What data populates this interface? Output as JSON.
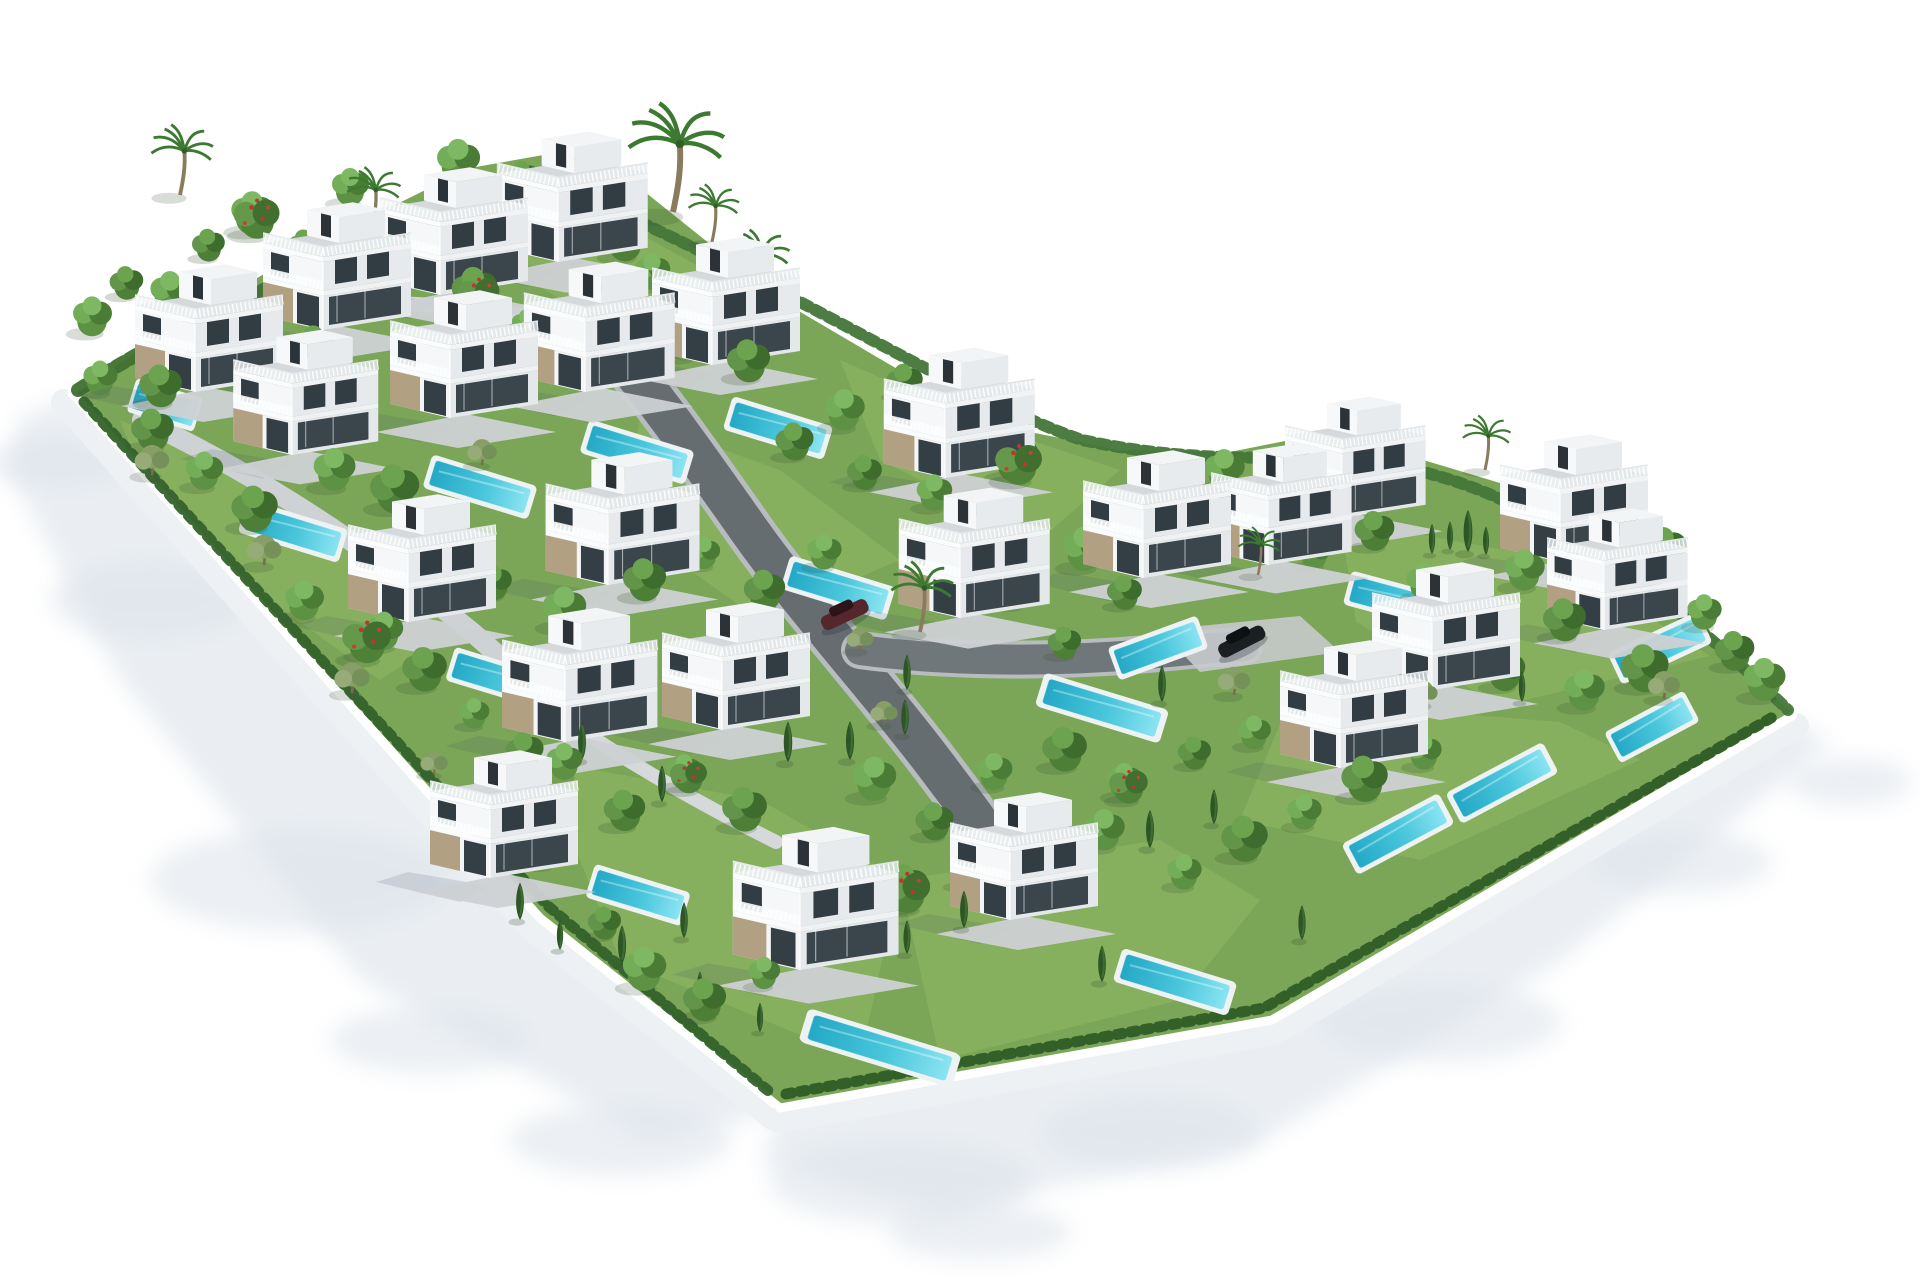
{
  "meta": {
    "description": "Aerial isometric 3D architectural rendering of a gated residential development: 24 white modern three-storey villas with rooftop terraces, railed balconies, stone-clad ground floors, private turquoise pools, green gardens with trees, palms and cypress hedges, curving grey internal roads, two parked cars, all enclosed by a white perimeter wall casting soft shadows on a white background.",
    "background": "#ffffff"
  },
  "palette": {
    "lawn_base": "#7ba657",
    "lawn_bright": "#8ab35f",
    "road_dark": "#666d71",
    "road_casing": "#b7bcbf",
    "path_light": "#ced2d4",
    "path_lighter": "#d6d9db",
    "apron": "#c6cacc",
    "wall_face": "#eef1f4",
    "wall_top": "#ffffff",
    "hedge_dark": "#34622b",
    "hedge_mid": "#45763a",
    "hedge_nw": "#3f7030",
    "pool_rim": "#eef2f3",
    "water_deep": "#23a8c6",
    "water_light": "#8ce4f2",
    "outer_shadow": "#dde3ea",
    "villa_face_bright": "#f5f7f8",
    "villa_face_shade": "#e4e8eb",
    "villa_deck": "#d5d9db",
    "glass": "#39444b",
    "stone": "#b2a083"
  },
  "scene": {
    "plot": [
      [
        72,
        396
      ],
      [
        180,
        322
      ],
      [
        320,
        242
      ],
      [
        470,
        168
      ],
      [
        560,
        152
      ],
      [
        640,
        188
      ],
      [
        780,
        300
      ],
      [
        950,
        400
      ],
      [
        1010,
        428
      ],
      [
        1120,
        450
      ],
      [
        1230,
        452
      ],
      [
        1330,
        432
      ],
      [
        1430,
        462
      ],
      [
        1540,
        495
      ],
      [
        1640,
        562
      ],
      [
        1795,
        716
      ],
      [
        1272,
        1020
      ],
      [
        780,
        1108
      ],
      [
        540,
        920
      ]
    ],
    "outer_shadows": {
      "polys": [
        [
          [
            66,
            398
          ],
          [
            540,
            922
          ],
          [
            780,
            1112
          ],
          [
            650,
            1142
          ],
          [
            360,
            980
          ],
          [
            120,
            680
          ],
          [
            8,
            470
          ],
          [
            20,
            418
          ]
        ],
        [
          [
            780,
            1112
          ],
          [
            1272,
            1024
          ],
          [
            1792,
            720
          ],
          [
            1832,
            742
          ],
          [
            1560,
            962
          ],
          [
            1260,
            1142
          ],
          [
            940,
            1212
          ],
          [
            760,
            1162
          ]
        ]
      ],
      "ellipses": [
        [
          300,
          880,
          150,
          52
        ],
        [
          150,
          600,
          100,
          40
        ],
        [
          620,
          1140,
          112,
          36
        ],
        [
          900,
          1182,
          132,
          42
        ],
        [
          1150,
          1132,
          110,
          38
        ],
        [
          1440,
          1022,
          122,
          40
        ],
        [
          1680,
          862,
          92,
          32
        ],
        [
          60,
          462,
          70,
          26
        ],
        [
          980,
          1232,
          92,
          28
        ],
        [
          1850,
          782,
          62,
          24
        ],
        [
          430,
          1040,
          100,
          34
        ]
      ]
    },
    "lawns": [
      [
        [
          1340,
          520
        ],
        [
          1560,
          560
        ],
        [
          1710,
          656
        ],
        [
          1500,
          706
        ],
        [
          1356,
          622
        ]
      ],
      [
        [
          1290,
          700
        ],
        [
          1560,
          722
        ],
        [
          1640,
          760
        ],
        [
          1420,
          860
        ],
        [
          1240,
          820
        ]
      ],
      [
        [
          540,
          760
        ],
        [
          760,
          800
        ],
        [
          900,
          880
        ],
        [
          860,
          1060
        ],
        [
          620,
          960
        ]
      ],
      [
        [
          900,
          880
        ],
        [
          1160,
          840
        ],
        [
          1260,
          900
        ],
        [
          1180,
          1000
        ],
        [
          940,
          1060
        ]
      ],
      [
        [
          640,
          420
        ],
        [
          780,
          470
        ],
        [
          900,
          560
        ],
        [
          760,
          620
        ],
        [
          620,
          520
        ]
      ],
      [
        [
          120,
          420
        ],
        [
          300,
          500
        ],
        [
          470,
          620
        ],
        [
          380,
          680
        ],
        [
          160,
          520
        ]
      ],
      [
        [
          840,
          360
        ],
        [
          1000,
          430
        ],
        [
          1120,
          470
        ],
        [
          1040,
          540
        ],
        [
          880,
          460
        ]
      ],
      [
        [
          560,
          190
        ],
        [
          760,
          300
        ],
        [
          660,
          360
        ],
        [
          480,
          250
        ]
      ]
    ],
    "walls": {
      "sw": {
        "top": "M 72,393 L 540,918 L 780,1108",
        "face": "M 64,402 L 532,928 L 774,1118"
      },
      "se": {
        "top": "M 780,1108 L 1272,1020 L 1792,716",
        "face": "M 778,1120 L 1274,1032 L 1796,726"
      }
    },
    "hedges": [
      {
        "d": "M 78,390 C 220,300 400,225 560,182",
        "w": 14,
        "color": "#3f7030",
        "dash": "9,6"
      },
      {
        "d": "M 572,192 C 780,280 960,398 1082,440 C 1240,474 1330,442 1434,475 C 1558,508 1690,614 1788,710",
        "w": 12,
        "color": "#45763a",
        "dash": "8,7"
      },
      {
        "d": "M 84,402 L 548,906 L 772,1094",
        "w": 11,
        "color": "#34622b",
        "dash": "6,8"
      },
      {
        "d": "M 786,1094 L 1264,1008 L 1778,714",
        "w": 11,
        "color": "#2f5c27",
        "dash": "6,8"
      }
    ],
    "roads": [
      {
        "d": "M 608,342 C 652,392 694,452 742,520 C 800,604 878,688 938,768 C 962,800 982,826 994,846",
        "w": 40,
        "color": "#666d71",
        "casing": 50
      },
      {
        "d": "M 860,650 C 948,662 1058,662 1148,654 C 1192,650 1218,647 1244,646",
        "w": 30,
        "color": "#70777b",
        "casing": 38
      },
      {
        "d": "M 142,420 C 252,472 362,542 472,632 C 512,667 542,697 562,717",
        "w": 20,
        "color": "#ced2d4",
        "casing": 0
      },
      {
        "d": "M 642,347 C 542,312 432,297 322,307 C 252,314 192,332 152,357",
        "w": 15,
        "color": "#d6d9db",
        "casing": 0
      },
      {
        "d": "M 562,717 C 630,764 700,804 776,842",
        "w": 14,
        "color": "#d6d9db",
        "casing": 0
      }
    ],
    "apron": [
      [
        1160,
        630
      ],
      [
        1300,
        616
      ],
      [
        1340,
        652
      ],
      [
        1200,
        672
      ]
    ],
    "pools": [
      [
        165,
        405,
        70,
        17
      ],
      [
        480,
        487,
        110,
        17
      ],
      [
        637,
        452,
        110,
        17
      ],
      [
        778,
        428,
        105,
        17
      ],
      [
        293,
        531,
        105,
        17
      ],
      [
        498,
        678,
        100,
        17
      ],
      [
        838,
        588,
        110,
        17
      ],
      [
        638,
        895,
        100,
        17
      ],
      [
        1102,
        708,
        130,
        17
      ],
      [
        1175,
        982,
        120,
        17
      ],
      [
        880,
        1048,
        160,
        17
      ],
      [
        1398,
        601,
        105,
        15
      ],
      [
        1660,
        648,
        100,
        -25
      ],
      [
        1158,
        648,
        95,
        -20
      ],
      [
        1652,
        727,
        90,
        -28
      ],
      [
        1502,
        783,
        110,
        -28
      ],
      [
        1398,
        834,
        110,
        -28
      ]
    ],
    "villas": [
      [
        195,
        392,
        1.0
      ],
      [
        323,
        330,
        1.0
      ],
      [
        440,
        295,
        1.0
      ],
      [
        558,
        262,
        1.02
      ],
      [
        292,
        455,
        0.98
      ],
      [
        450,
        418,
        1.0
      ],
      [
        585,
        392,
        1.02
      ],
      [
        712,
        365,
        1.0
      ],
      [
        945,
        478,
        1.02
      ],
      [
        1143,
        578,
        1.0
      ],
      [
        1268,
        565,
        0.95
      ],
      [
        1342,
        518,
        0.95
      ],
      [
        1560,
        562,
        1.0
      ],
      [
        1604,
        630,
        0.95
      ],
      [
        408,
        622,
        1.0
      ],
      [
        608,
        585,
        1.04
      ],
      [
        960,
        618,
        1.02
      ],
      [
        1432,
        690,
        1.0
      ],
      [
        565,
        742,
        1.05
      ],
      [
        722,
        730,
        1.0
      ],
      [
        1340,
        768,
        1.0
      ],
      [
        490,
        878,
        1.0
      ],
      [
        800,
        970,
        1.12
      ],
      [
        1010,
        920,
        1.0
      ]
    ],
    "cars": [
      {
        "x": 845,
        "y": 615,
        "angle": -25,
        "body": "#55262c",
        "roof": "#2c1418"
      },
      {
        "x": 1242,
        "y": 642,
        "angle": -27,
        "body": "#1b1f22",
        "roof": "#0e1113"
      }
    ],
    "trees": [
      [
        92,
        330,
        "t"
      ],
      [
        126,
        294,
        "t"
      ],
      [
        170,
        306,
        "t"
      ],
      [
        208,
        256,
        "t"
      ],
      [
        252,
        228,
        "t"
      ],
      [
        304,
        258,
        "t"
      ],
      [
        350,
        200,
        "t"
      ],
      [
        402,
        232,
        "t"
      ],
      [
        458,
        176,
        "t"
      ],
      [
        522,
        190,
        "t"
      ],
      [
        592,
        210,
        "t"
      ],
      [
        624,
        254,
        "t"
      ],
      [
        652,
        284,
        "t"
      ],
      [
        700,
        320,
        "t"
      ],
      [
        100,
        390,
        "t"
      ],
      [
        160,
        400,
        "t"
      ],
      [
        230,
        380,
        "t"
      ],
      [
        314,
        360,
        "t"
      ],
      [
        358,
        305,
        "t"
      ],
      [
        474,
        305,
        "t"
      ],
      [
        526,
        335,
        "t"
      ],
      [
        614,
        315,
        "t"
      ],
      [
        684,
        355,
        "t"
      ],
      [
        748,
        375,
        "t"
      ],
      [
        334,
        484,
        "t"
      ],
      [
        394,
        505,
        "t"
      ],
      [
        304,
        614,
        "t"
      ],
      [
        364,
        654,
        "t"
      ],
      [
        434,
        549,
        "t"
      ],
      [
        494,
        594,
        "t"
      ],
      [
        564,
        624,
        "t"
      ],
      [
        644,
        594,
        "t"
      ],
      [
        704,
        564,
        "t"
      ],
      [
        764,
        604,
        "t"
      ],
      [
        824,
        564,
        "t"
      ],
      [
        864,
        484,
        "t"
      ],
      [
        934,
        505,
        "t"
      ],
      [
        794,
        454,
        "t"
      ],
      [
        844,
        424,
        "t"
      ],
      [
        904,
        394,
        "t"
      ],
      [
        964,
        434,
        "t"
      ],
      [
        1014,
        474,
        "t"
      ],
      [
        1084,
        564,
        "t"
      ],
      [
        1124,
        604,
        "t"
      ],
      [
        1014,
        604,
        "t"
      ],
      [
        1064,
        654,
        "t"
      ],
      [
        1224,
        484,
        "t"
      ],
      [
        1274,
        524,
        "t"
      ],
      [
        1314,
        564,
        "t"
      ],
      [
        1374,
        544,
        "t"
      ],
      [
        1424,
        594,
        "t"
      ],
      [
        1484,
        624,
        "t"
      ],
      [
        1524,
        584,
        "t"
      ],
      [
        1564,
        634,
        "t"
      ],
      [
        1624,
        604,
        "t"
      ],
      [
        1664,
        564,
        "t"
      ],
      [
        1704,
        624,
        "t"
      ],
      [
        1734,
        664,
        "t"
      ],
      [
        1764,
        694,
        "t"
      ],
      [
        1644,
        684,
        "t"
      ],
      [
        1584,
        704,
        "t"
      ],
      [
        1504,
        684,
        "t"
      ],
      [
        564,
        774,
        "t"
      ],
      [
        624,
        824,
        "t"
      ],
      [
        684,
        784,
        "t"
      ],
      [
        744,
        824,
        "t"
      ],
      [
        874,
        794,
        "t"
      ],
      [
        934,
        834,
        "t"
      ],
      [
        994,
        784,
        "t"
      ],
      [
        1064,
        764,
        "t"
      ],
      [
        1124,
        794,
        "t"
      ],
      [
        1194,
        764,
        "t"
      ],
      [
        1254,
        744,
        "t"
      ],
      [
        904,
        904,
        "t"
      ],
      [
        964,
        884,
        "t"
      ],
      [
        1034,
        864,
        "t"
      ],
      [
        1104,
        844,
        "t"
      ],
      [
        824,
        954,
        "t"
      ],
      [
        764,
        984,
        "t"
      ],
      [
        704,
        1014,
        "t"
      ],
      [
        644,
        984,
        "t"
      ],
      [
        604,
        934,
        "t"
      ],
      [
        1184,
        884,
        "t"
      ],
      [
        1244,
        854,
        "t"
      ],
      [
        1304,
        824,
        "t"
      ],
      [
        1364,
        794,
        "t"
      ],
      [
        1424,
        764,
        "t"
      ],
      [
        524,
        764,
        "t"
      ],
      [
        474,
        724,
        "t"
      ],
      [
        424,
        684,
        "t"
      ],
      [
        384,
        644,
        "t"
      ],
      [
        254,
        524,
        "t"
      ],
      [
        204,
        484,
        "t"
      ],
      [
        152,
        444,
        "t"
      ],
      [
        366,
        656,
        "f"
      ],
      [
        478,
        308,
        "f"
      ],
      [
        906,
        906,
        "f"
      ],
      [
        1018,
        478,
        "f"
      ],
      [
        688,
        788,
        "f"
      ],
      [
        438,
        553,
        "f"
      ],
      [
        256,
        232,
        "f"
      ],
      [
        1128,
        798,
        "f"
      ],
      [
        454,
        364,
        "f"
      ],
      [
        262,
        434,
        "o"
      ],
      [
        482,
        464,
        "o"
      ],
      [
        702,
        704,
        "o"
      ],
      [
        544,
        864,
        "o"
      ],
      [
        434,
        774,
        "o"
      ],
      [
        884,
        724,
        "o"
      ],
      [
        1234,
        694,
        "o"
      ],
      [
        1424,
        704,
        "o"
      ],
      [
        264,
        564,
        "o"
      ],
      [
        352,
        692,
        "o"
      ],
      [
        152,
        474,
        "o"
      ],
      [
        1664,
        698,
        "o"
      ],
      [
        860,
        650,
        "o"
      ],
      [
        953,
        562,
        "c"
      ],
      [
        998,
        548,
        "c"
      ],
      [
        1432,
        554,
        "c"
      ],
      [
        1450,
        550,
        "c"
      ],
      [
        1468,
        552,
        "c"
      ],
      [
        1486,
        555,
        "c"
      ],
      [
        907,
        690,
        "c"
      ],
      [
        1162,
        702,
        "c"
      ],
      [
        662,
        802,
        "c"
      ],
      [
        582,
        760,
        "c"
      ],
      [
        622,
        964,
        "c"
      ],
      [
        684,
        938,
        "c"
      ],
      [
        907,
        954,
        "c"
      ],
      [
        964,
        928,
        "c"
      ],
      [
        1040,
        900,
        "c"
      ],
      [
        1150,
        848,
        "c"
      ],
      [
        1214,
        824,
        "c"
      ],
      [
        1350,
        764,
        "c"
      ],
      [
        738,
        702,
        "c"
      ],
      [
        788,
        762,
        "c"
      ],
      [
        1397,
        690,
        "c"
      ],
      [
        1302,
        940,
        "c"
      ],
      [
        1102,
        982,
        "c"
      ],
      [
        1522,
        702,
        "c"
      ],
      [
        700,
        1000,
        "c"
      ],
      [
        760,
        1032,
        "c"
      ],
      [
        850,
        760,
        "c"
      ],
      [
        905,
        735,
        "c"
      ],
      [
        520,
        920,
        "c"
      ],
      [
        560,
        950,
        "c"
      ],
      [
        180,
        195,
        "p",
        1.1
      ],
      [
        372,
        228,
        "p",
        0.95
      ],
      [
        497,
        247,
        "p",
        0.95
      ],
      [
        673,
        212,
        "p",
        1.7
      ],
      [
        712,
        242,
        "p",
        0.9
      ],
      [
        758,
        297,
        "p",
        1.05
      ],
      [
        920,
        632,
        "p",
        1.1
      ],
      [
        1192,
        556,
        "p",
        0.9
      ],
      [
        1258,
        575,
        "p",
        0.75
      ],
      [
        1485,
        470,
        "p",
        0.85
      ]
    ]
  }
}
